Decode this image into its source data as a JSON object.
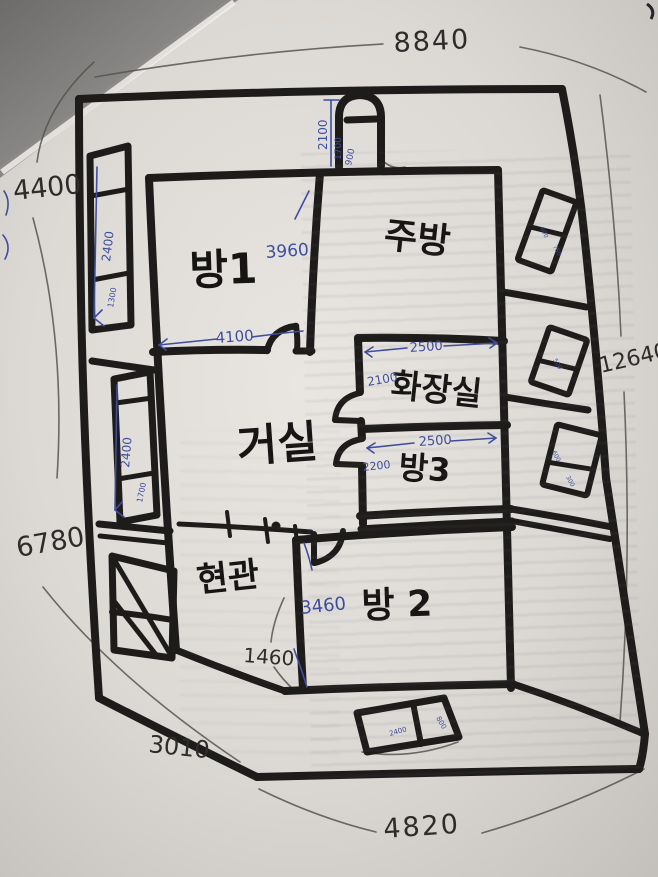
{
  "drawing": {
    "rooms": {
      "room1": "방1",
      "kitchen": "주방",
      "living": "거실",
      "bathroom": "화장실",
      "room3": "방3",
      "entrance": "현관",
      "room2": "방 2"
    },
    "dims_black": {
      "top": "8840",
      "left_upper": "4400",
      "right_side": "12640",
      "left_lower": "6780",
      "diagonal": "3010",
      "bottom": "4820",
      "entry_width": "1460"
    },
    "dims_blue": {
      "door_h": "2100",
      "door_mid": "1700",
      "door_w": "900",
      "room1_h": "3960",
      "room1_w": "4100",
      "bath_w": "2500",
      "bath_h": "2100",
      "room3_w": "2500",
      "room3_h": "2200",
      "room2_h": "3460",
      "win_l1_h": "2400",
      "win_l1_s": "1300",
      "win_l2_h": "2400",
      "win_l2_s": "1700",
      "win_b_w": "2400",
      "win_b_h": "800",
      "win_r1_a": "600",
      "win_r1_b": "750",
      "win_r2_a": "500",
      "win_r3_a": "600",
      "win_r3_b": "300"
    },
    "colors": {
      "marker_ink": "#1e1c1a",
      "ballpoint_blue": "#3f4d9e",
      "pencil_gray": "#57534e",
      "paper": "#dfdcd8"
    }
  }
}
